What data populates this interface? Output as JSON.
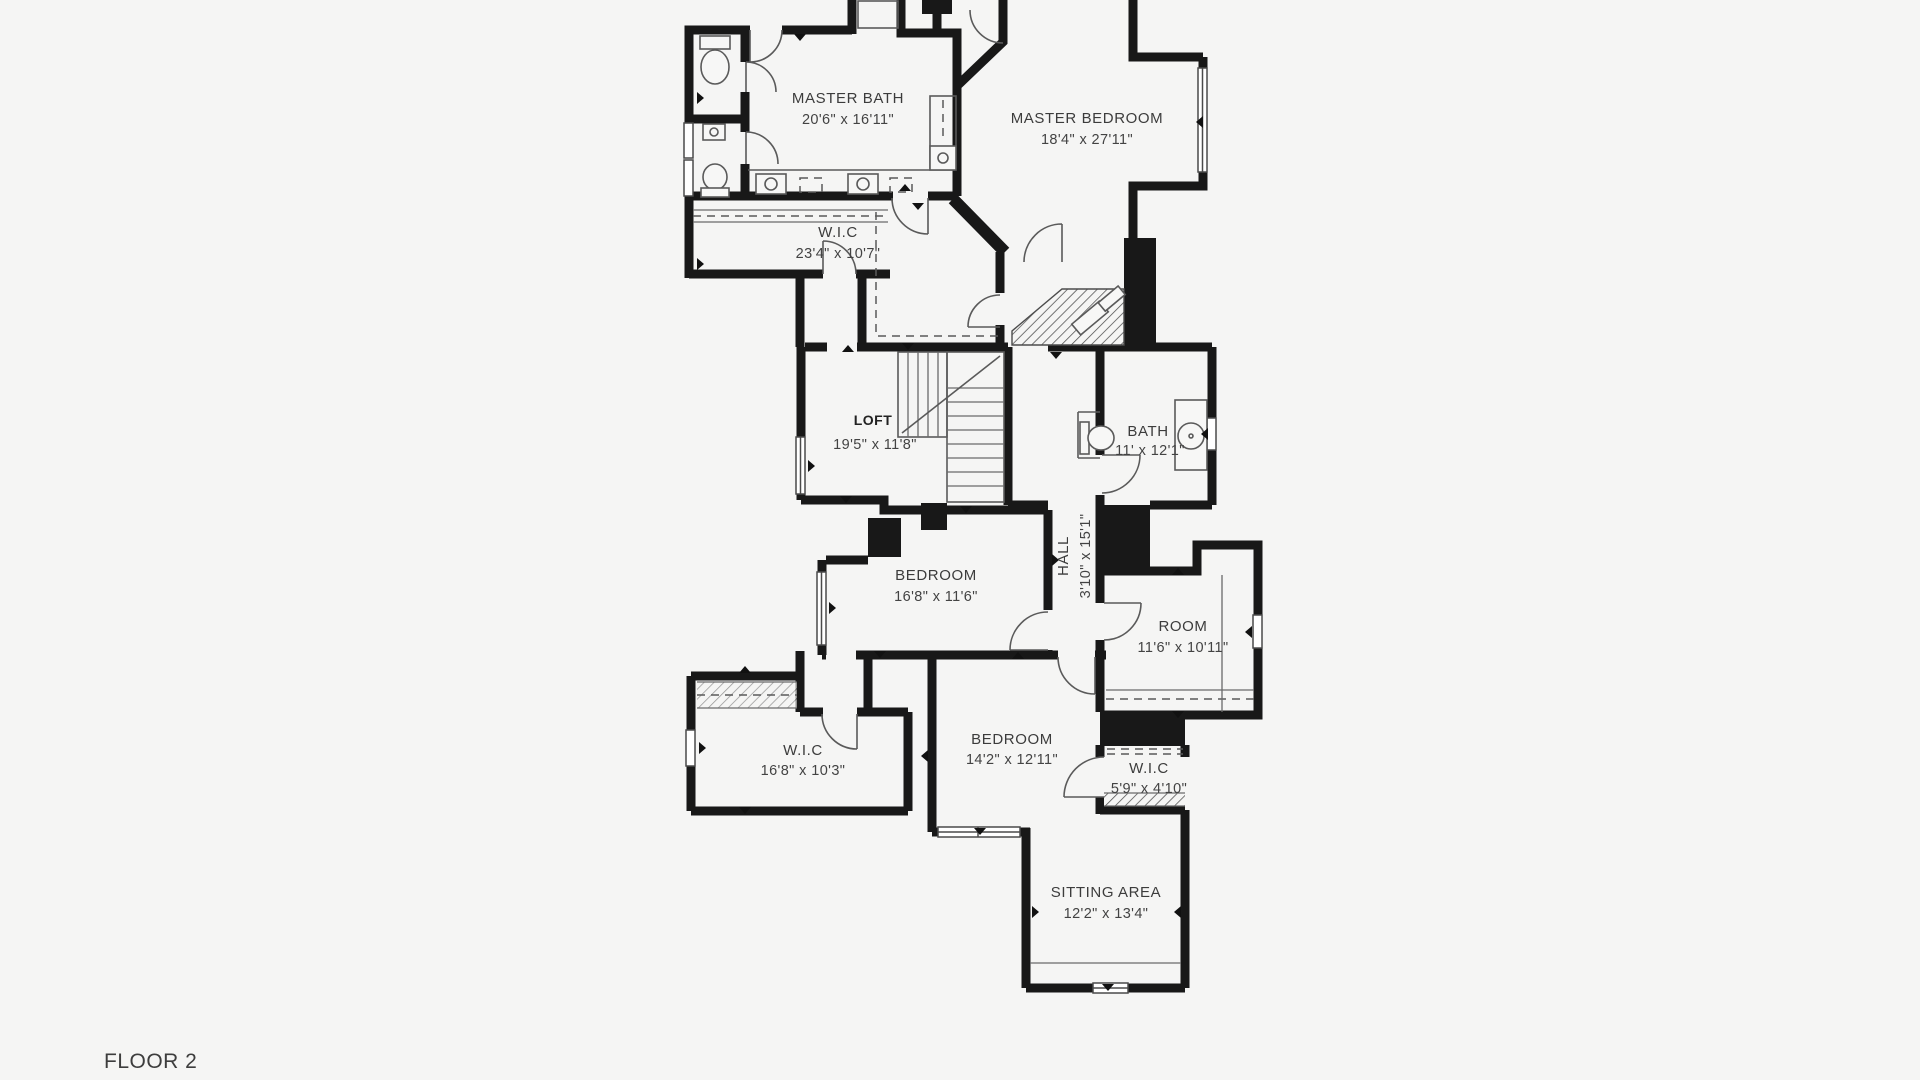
{
  "floor_label": "FLOOR 2",
  "plan": {
    "background": "#f5f5f4",
    "wall_color": "#181818",
    "rooms": [
      {
        "name": "MASTER BATH",
        "dims": "20'6\" x 16'11\""
      },
      {
        "name": "MASTER BEDROOM",
        "dims": "18'4\" x 27'11\""
      },
      {
        "name": "W.I.C",
        "dims": "23'4\" x 10'7\""
      },
      {
        "name": "LOFT",
        "dims": "19'5\" x 11'8\""
      },
      {
        "name": "BATH",
        "dims": "11' x 12'1\""
      },
      {
        "name": "HALL",
        "dims": "3'10\" x 15'1\""
      },
      {
        "name": "BEDROOM",
        "dims": "16'8\" x 11'6\""
      },
      {
        "name": "ROOM",
        "dims": "11'6\" x 10'11\""
      },
      {
        "name": "W.I.C",
        "dims": "16'8\" x 10'3\""
      },
      {
        "name": "BEDROOM",
        "dims": "14'2\" x 12'11\""
      },
      {
        "name": "W.I.C",
        "dims": "5'9\" x 4'10\""
      },
      {
        "name": "SITTING AREA",
        "dims": "12'2\" x 13'4\""
      }
    ]
  }
}
